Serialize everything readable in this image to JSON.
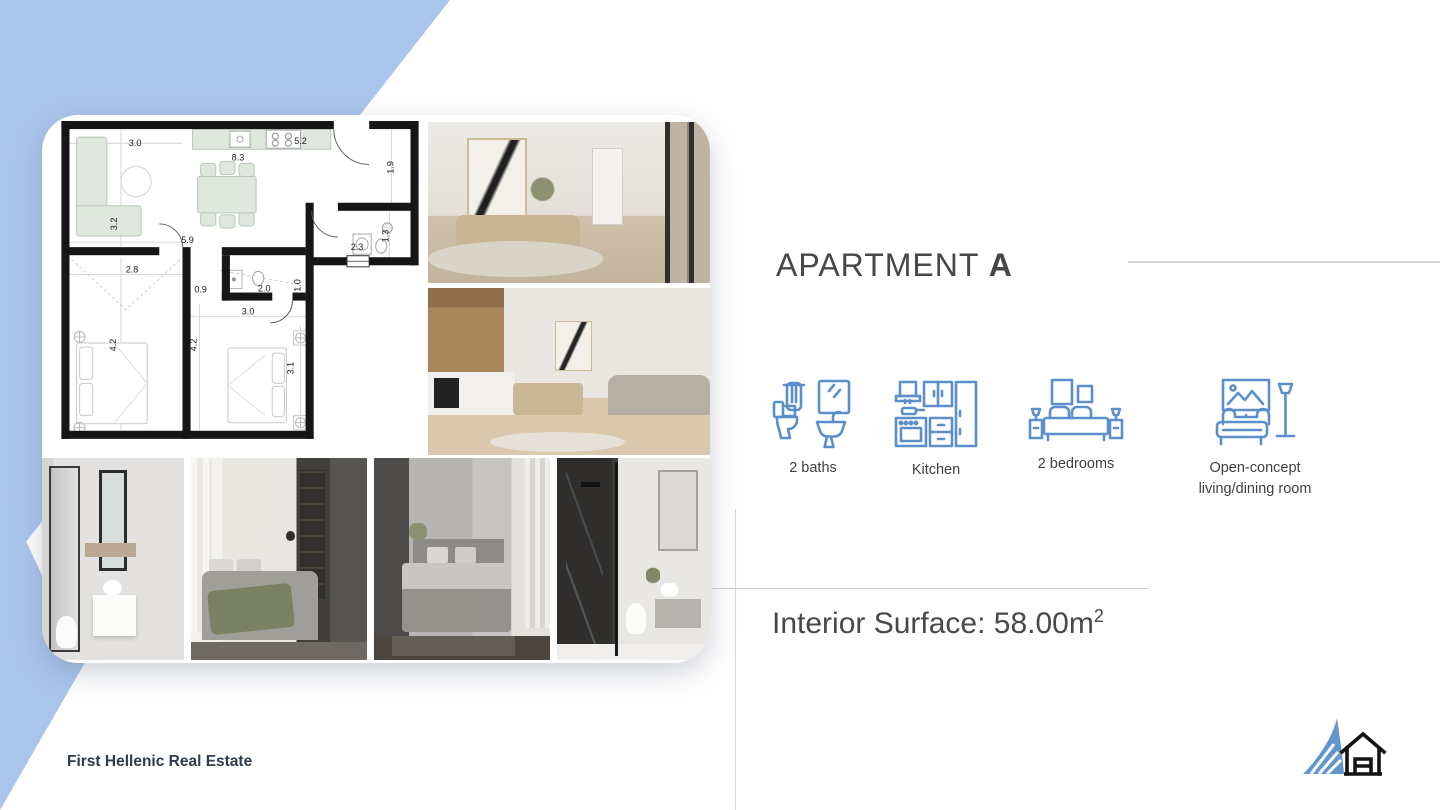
{
  "title": {
    "prefix": "APARTMENT ",
    "emphasis": "A"
  },
  "features": [
    {
      "icon": "bathroom-icon",
      "label": "2 baths"
    },
    {
      "icon": "kitchen-icon",
      "label": "Kitchen"
    },
    {
      "icon": "bedroom-icon",
      "label": "2 bedrooms"
    },
    {
      "icon": "sofa-lamp-icon",
      "label": "Open-concept living/dining room"
    }
  ],
  "surface": {
    "text": "Interior Surface: 58.00m",
    "superscript": "2"
  },
  "footer": {
    "company": "First Hellenic Real Estate"
  },
  "floor_plan": {
    "dimensions": [
      "3.0",
      "8.3",
      "5.2",
      "1.9",
      "3.2",
      "5.9",
      "2.3",
      "1.3",
      "2.8",
      "0.9",
      "2.0",
      "1.0",
      "3.0",
      "4.2",
      "4.2",
      "3.1"
    ]
  },
  "photos": [
    "dining-room-photo",
    "kitchen-living-room-photo",
    "bathroom-photo",
    "bedroom-photo",
    "second-bedroom-photo",
    "shower-bathroom-photo"
  ],
  "colors": {
    "accent_blue": "#aac5ec",
    "icon_blue": "#5b8fcb",
    "logo_blue": "#6496ce",
    "title_gray": "#474747",
    "footer_navy": "#2e3c4d",
    "line_gray": "#d2d2d2"
  }
}
